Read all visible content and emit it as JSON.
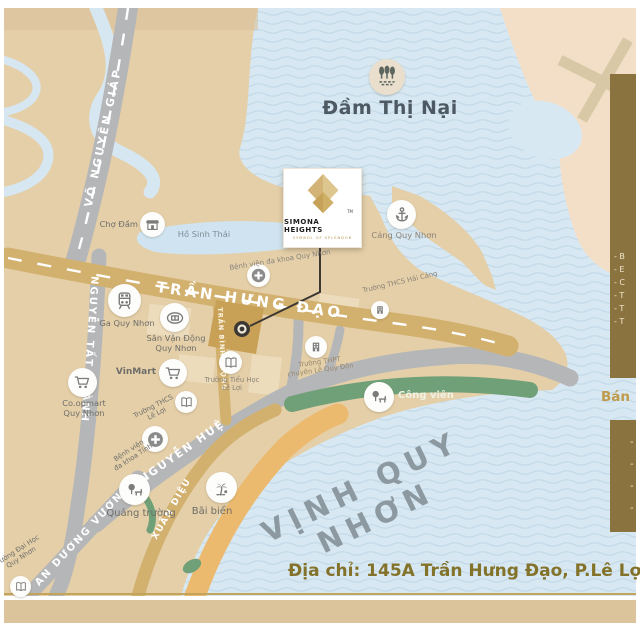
{
  "water": {
    "dam_thi_nai": "Đầm Thị Nại",
    "bay": "VỊNH QUY NHƠN"
  },
  "logo": {
    "brand": "SIMONA HEIGHTS",
    "tagline": "SYMBOL OF SPLENDOR",
    "tm": "TM"
  },
  "roads": {
    "vo_nguyen_giap": "VÕ NGUYÊN GIÁP",
    "tran_hung_dao": "TRẦN HƯNG ĐẠO",
    "nguyen_tat_thanh": "NGUYỄN TẤT THÀNH",
    "tran_binh_trong": "TRẦN BÌNH TRỌNG",
    "nguyen_hue": "NGUYỄN HUỆ",
    "xuan_dieu": "XUÂN DIỆU",
    "an_duong_vuong": "AN DƯƠNG VƯƠNG"
  },
  "landmarks": {
    "cho_dam": "Chợ Đầm",
    "ho_sinh_thai": "Hồ Sinh Thái",
    "bv_quy_nhon": "Bệnh viện đa khoa Quy Nhơn",
    "ga_quy_nhon": "Ga Quy Nhơn",
    "san_van_dong": "Sân Vận Động\nQuy Nhơn",
    "vinmart": "VinMart",
    "coopmart": "Co.opmart\nQuy Nhơn",
    "tieu_hoc_le_loi": "Trường Tiểu Học\nLê Lợi",
    "thcs_le_loi": "Trường THCS\nLê Lợi",
    "bv_tinh": "Bệnh viện\nđa khoa Tỉnh",
    "cang_quy_nhon": "Cảng Quy Nhơn",
    "thcs_hai_cang": "Trường THCS Hải Cảng",
    "thpt_le_quy_don": "Trường THPT\nchuyên Lê Quý Đôn",
    "cong_vien": "Công viên",
    "quang_truong": "Quảng trường",
    "bai_bien": "Bãi biển",
    "dai_hoc": "Trường Đại Học\nQuy Nhơn"
  },
  "side_panel": {
    "bullets_top": [
      "- B",
      "- E",
      "- C",
      "- T",
      "- T",
      "- T"
    ],
    "heading_partial": "Bán",
    "bullets_bottom": [
      "-",
      "-",
      "-",
      "-"
    ]
  },
  "footer": {
    "address": "Địa chỉ: 145A Trần Hưng Đạo, P.Lê Lợi, TP."
  },
  "colors": {
    "water": "#d8e8f2",
    "wave": "#bed7e5",
    "land": "#e4cfa8",
    "land_east": "#f3dfc7",
    "road_gray": "#b5b6b8",
    "road_gold": "#d2b06e",
    "park_green": "#70a078",
    "beach": "#ecba6e",
    "panel_gold": "#8b7340",
    "project_block": "#c8a157",
    "address_text": "#83722a",
    "bay_text": "#8c99a1"
  }
}
